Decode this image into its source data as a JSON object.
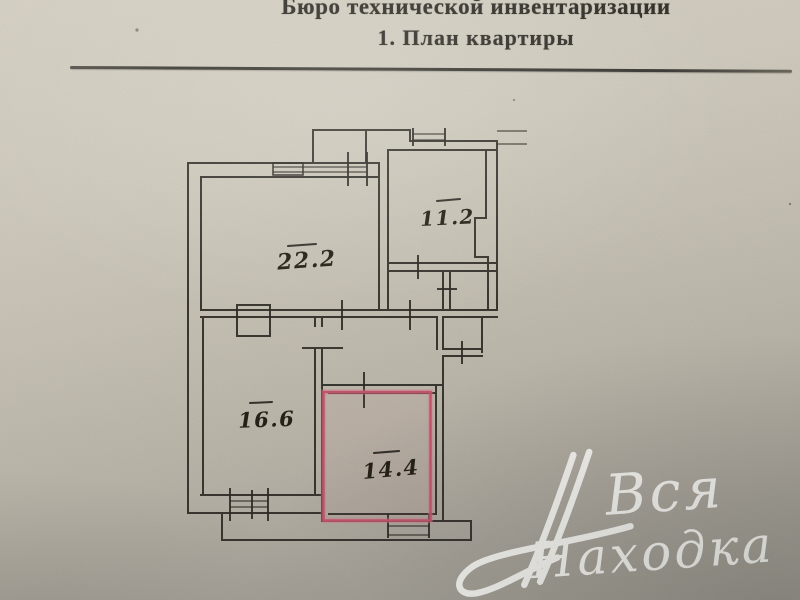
{
  "document": {
    "title_line1": "Бюро технической инвентаризации",
    "title_line2": "1. План квартиры"
  },
  "plan": {
    "ink_color": "#2f2b26",
    "highlight_color": "#c4566e",
    "rooms": [
      {
        "id": "room-1",
        "area": "22.2",
        "highlighted": false
      },
      {
        "id": "room-2",
        "area": "11.2",
        "highlighted": false
      },
      {
        "id": "room-3",
        "area": "16.6",
        "highlighted": false
      },
      {
        "id": "room-4",
        "area": "14.4",
        "highlighted": true
      }
    ]
  },
  "watermark": {
    "word1": "Вся",
    "word2": "Находка",
    "color": "#fcfcf8"
  }
}
